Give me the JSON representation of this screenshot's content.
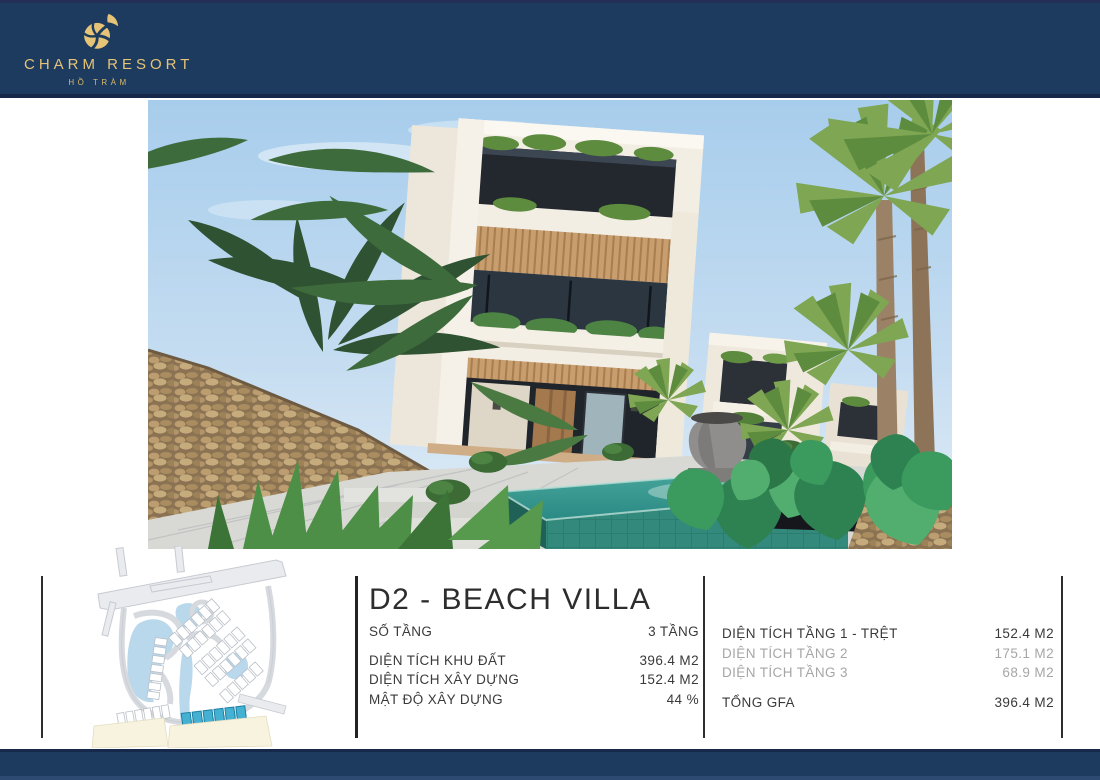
{
  "brand": {
    "name": "CHARM RESORT",
    "location": "HỒ TRÀM",
    "colors": {
      "navy": "#1d3b5e",
      "gold": "#e5c377"
    }
  },
  "villa": {
    "title": "D2 - BEACH VILLA",
    "specs_left": [
      {
        "label": "SỐ TẦNG",
        "value": "3 TẦNG"
      },
      {
        "label": "DIỆN TÍCH KHU ĐẤT",
        "value": "396.4 M2"
      },
      {
        "label": "DIỆN TÍCH XÂY DỰNG",
        "value": "152.4 M2"
      },
      {
        "label": "MẬT ĐỘ XÂY DỰNG",
        "value": "44 %"
      }
    ],
    "specs_right": [
      {
        "label": "DIỆN TÍCH TẦNG 1 - TRỆT",
        "value": "152.4 M2"
      },
      {
        "label": "DIỆN TÍCH TẦNG 2",
        "value": "175.1 M2"
      },
      {
        "label": "DIỆN TÍCH TẦNG 3",
        "value": "68.9 M2"
      },
      {
        "label": "TỔNG GFA",
        "value": "396.4 M2"
      }
    ]
  },
  "icons": {
    "logo_mark": "nautilus-shell",
    "hero": "villa-rendering",
    "map": "masterplan-sitemap"
  }
}
